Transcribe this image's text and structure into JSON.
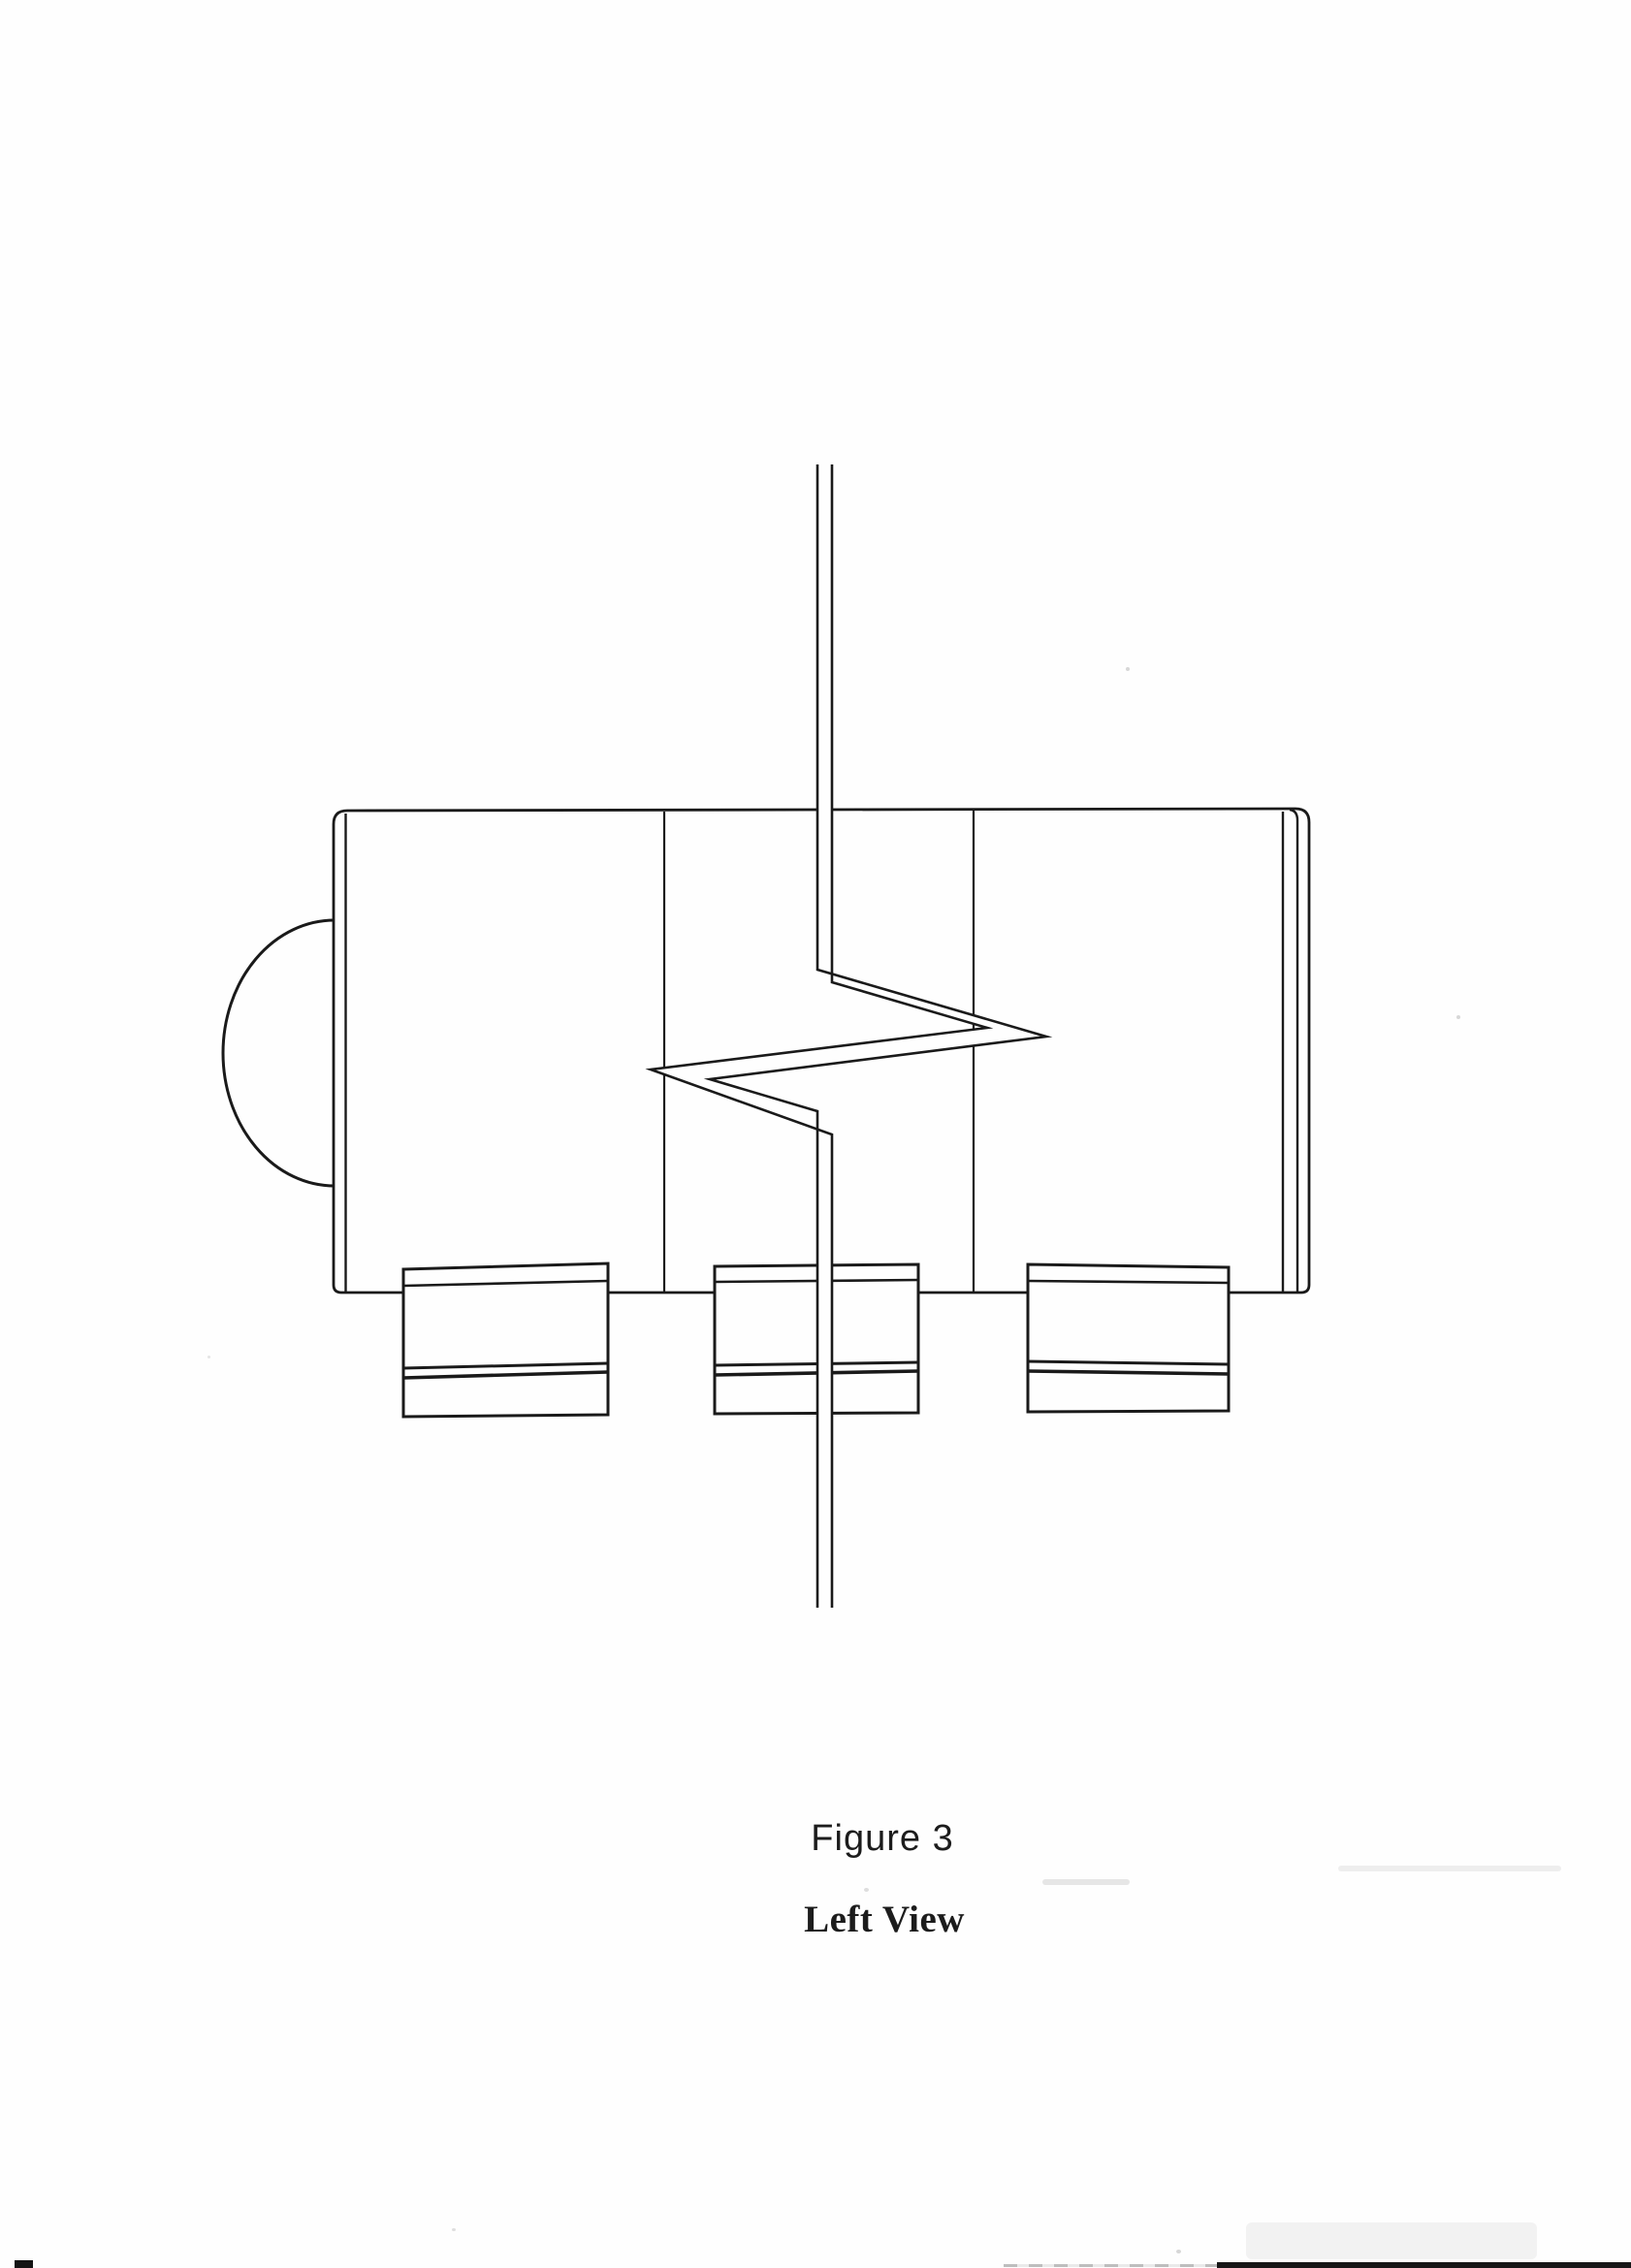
{
  "document": {
    "type": "scanned technical drawing page",
    "colors": {
      "paper": "#fefefe",
      "ink": "#1a1a1a"
    }
  },
  "caption": {
    "figure_label": "Figure 3",
    "view_label": "Left View"
  },
  "drawing": {
    "description": "Left view of cylindrical device body with domed left end, three mounting tabs on the underside, and a vertical shaft shown with a zigzag break symbol"
  }
}
